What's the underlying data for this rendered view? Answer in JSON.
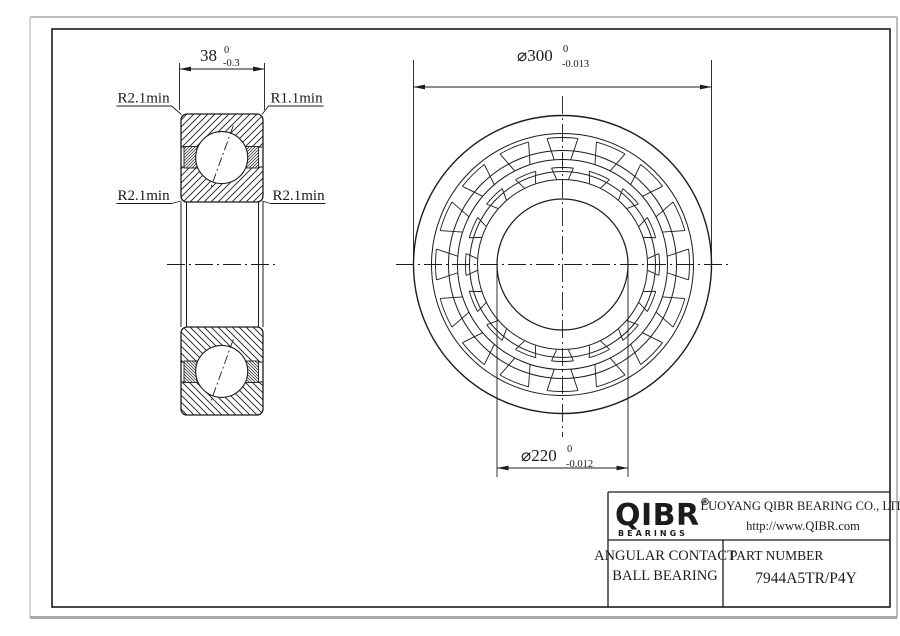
{
  "drawing": {
    "colors": {
      "line": "#1c1c1c",
      "sheet_edge": "#a9a9a9"
    },
    "section_view": {
      "width_dim": {
        "value": "38",
        "tol_upper": "0",
        "tol_lower": "-0.3"
      },
      "labels": {
        "top_left": "R2.1min",
        "top_right": "R1.1min",
        "mid_left": "R2.1min",
        "mid_right": "R2.1min"
      }
    },
    "front_view": {
      "outer_dia_dim": {
        "value": "⌀300",
        "tol_upper": "0",
        "tol_lower": "-0.013"
      },
      "bore_dia_dim": {
        "value": "⌀220",
        "tol_upper": "0",
        "tol_lower": "-0.012"
      }
    },
    "title_block": {
      "logo_text": "QIBR",
      "logo_reg": "®",
      "logo_sub": "BEARINGS",
      "company": "LUOYANG QIBR BEARING CO., LTD",
      "website": "http://www.QIBR.com",
      "product_line1": "ANGULAR CONTACT",
      "product_line2": "BALL BEARING",
      "part_label": "PART NUMBER",
      "part_number": "7944A5TR/P4Y"
    }
  }
}
